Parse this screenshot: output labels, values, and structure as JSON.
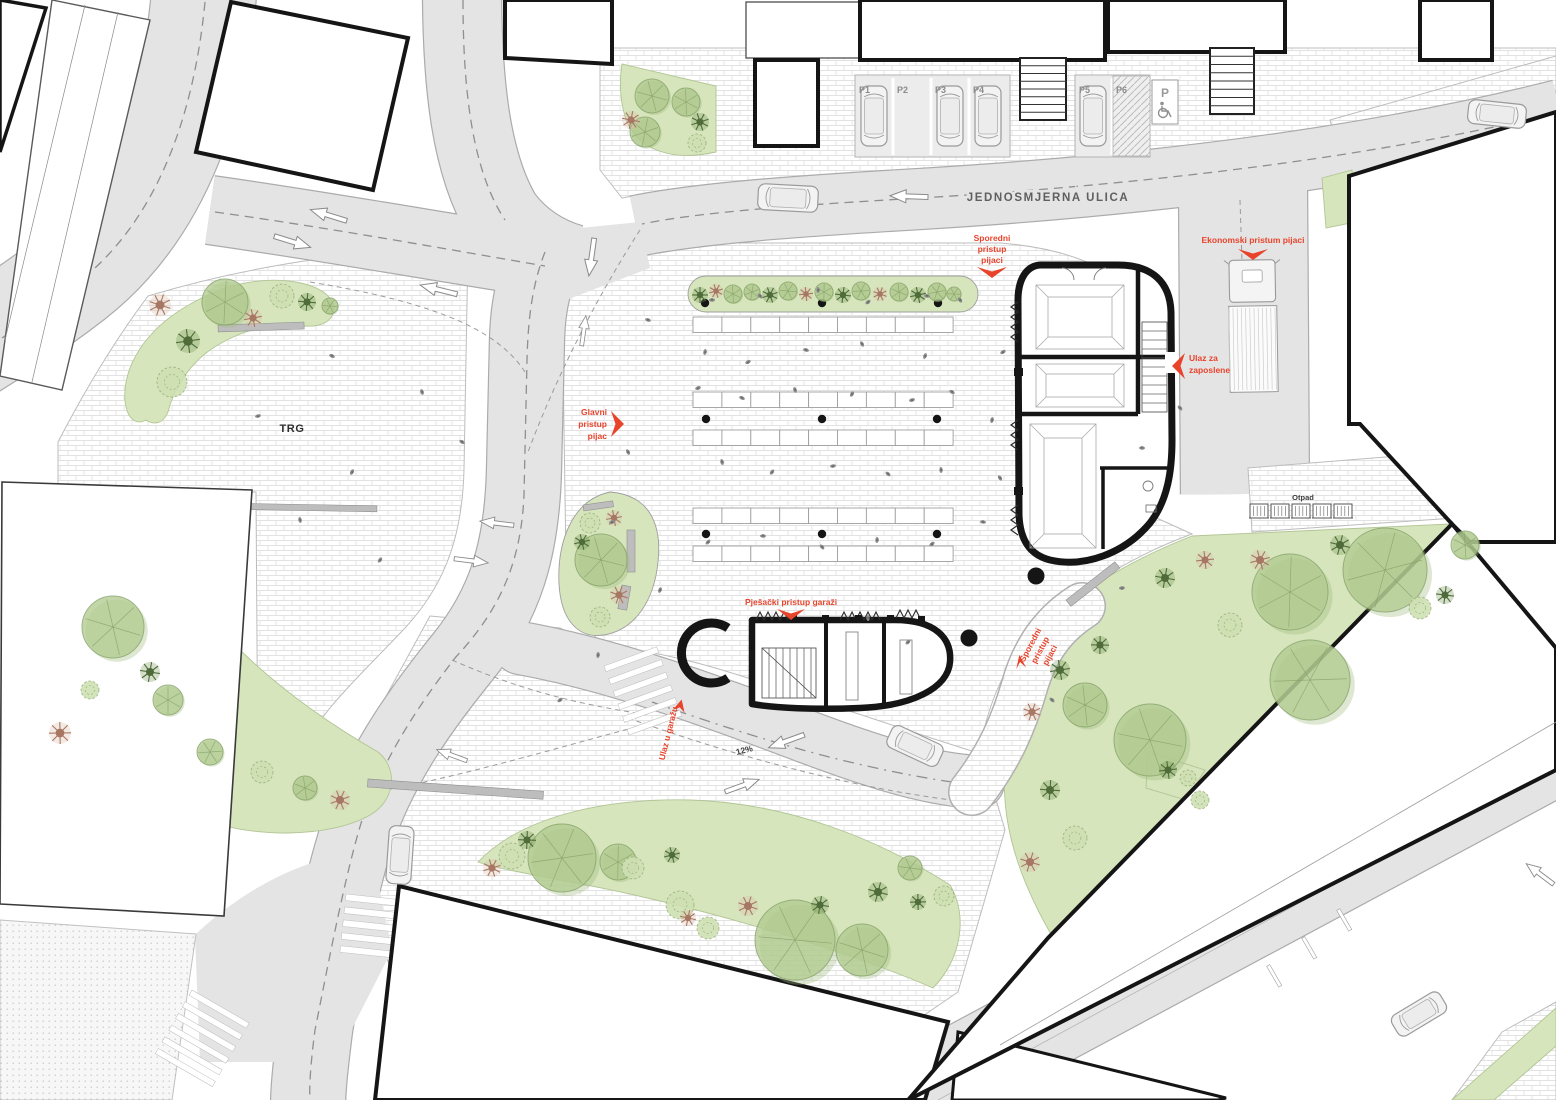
{
  "plan": {
    "type": "architectural site plan - market square (pijaca) with underground garage",
    "street": {
      "one_way_label": "JEDNOSMJERNA ULICA"
    },
    "parking": {
      "space_labels": [
        "P1",
        "P2",
        "P3",
        "P4",
        "P5",
        "P6"
      ],
      "occupied": [
        "P1",
        "P3",
        "P4",
        "P5"
      ],
      "disabled_sign_letter": "P"
    },
    "labels": {
      "trg": "TRG",
      "otpad": "Otpad",
      "ramp_grade": "12%",
      "glavni_1": "Glavni",
      "glavni_2": "pristup",
      "glavni_3": "pijac",
      "sporedni_top_1": "Sporedni",
      "sporedni_top_2": "pristup",
      "sporedni_top_3": "pijaci",
      "ekonomski": "Ekonomski pristum pijaci",
      "ulaz_zap_1": "Ulaz za",
      "ulaz_zap_2": "zaposlene",
      "pjesacki": "Pješački pristup garaži",
      "ulaz_garazu": "Ulaz u garažu",
      "sporedni_bot_1": "Sporedni",
      "sporedni_bot_2": "pristup",
      "sporedni_bot_3": "pijaci"
    },
    "icons": {
      "disabled_parking": "wheelchair-icon",
      "traffic_direction": "road-arrow-icon",
      "access_marker": "red-chevron-icon",
      "vegetation": "tree-icon",
      "vehicle": "car-icon",
      "delivery": "truck-icon",
      "waste": "waste-container-icon"
    },
    "colors": {
      "accent_red": "#e8432b",
      "road": "#e4e4e4",
      "curb": "#ababab",
      "brick_line": "#e2e2e2",
      "green": "#d6e5bc",
      "tree_green": "#b3cc92",
      "tree_dark": "#5f8244",
      "tree_pink": "#ddb8a5",
      "building_line": "#151515"
    }
  }
}
